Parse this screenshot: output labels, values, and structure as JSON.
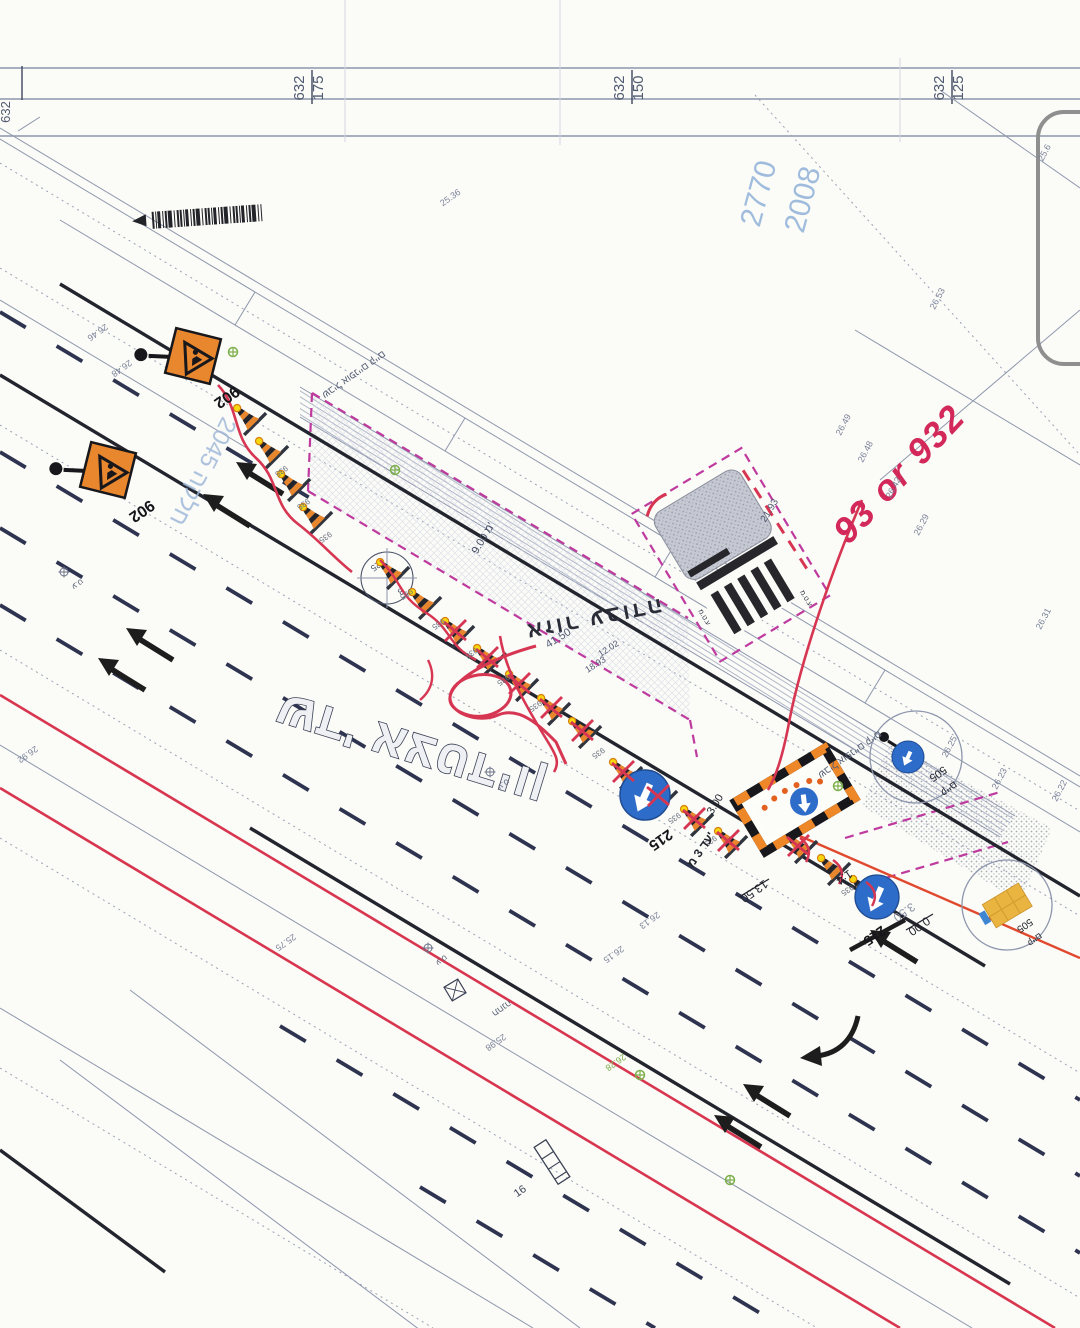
{
  "stations": {
    "edge": "632",
    "s1": {
      "a": "632",
      "b": "175"
    },
    "s2": {
      "a": "632",
      "b": "150"
    },
    "s3": {
      "a": "632",
      "b": "125"
    }
  },
  "cadastre": {
    "block1": "2770",
    "block2": "2008",
    "parcel": "חלקה 2045"
  },
  "titles": {
    "work_zone": "אזור עבודה",
    "street": "שד' אצטדיון",
    "bike1": "שביל אופניים קיים",
    "bike2": "שביל אופניים קיים"
  },
  "red_markup": {
    "note": "93 or 932"
  },
  "signs": {
    "roadworks": "902",
    "keep": "215",
    "cone": "935",
    "bus": "505",
    "existing": "קיים"
  },
  "dims": {
    "d4150": "41.50",
    "d1202": "12.02",
    "d1893": "18.93",
    "d900": "9.00 מ'",
    "d2193": "21.93",
    "d300": "3.00",
    "dupto": "עד 3 מ'",
    "d1350": "13.50",
    "d14": "1:4",
    "d350": "3.50",
    "d000": "0.00"
  },
  "elevations": [
    "26.46",
    "26.48",
    "25.36",
    "26.53",
    "26.49",
    "26.48",
    "26.42",
    "26.29",
    "26.92",
    "26.25",
    "26.23",
    "26.31",
    "26.22",
    "26.13",
    "26.15",
    "25.98",
    "25.75",
    "26.28",
    "25.6"
  ],
  "survey": {
    "pt": "ע.ט",
    "station": "תחנה",
    "xwalk": "ע.ט.מ",
    "n16": "16",
    "tree_a": "25",
    "tree_b": "8"
  },
  "colors": {
    "boundary_magenta": "#bf3a9e",
    "markup_red": "#d8354f",
    "sign_orange": "#e8872e",
    "sign_blue": "#2e6cc9",
    "lamp_yellow": "#f6d712"
  }
}
